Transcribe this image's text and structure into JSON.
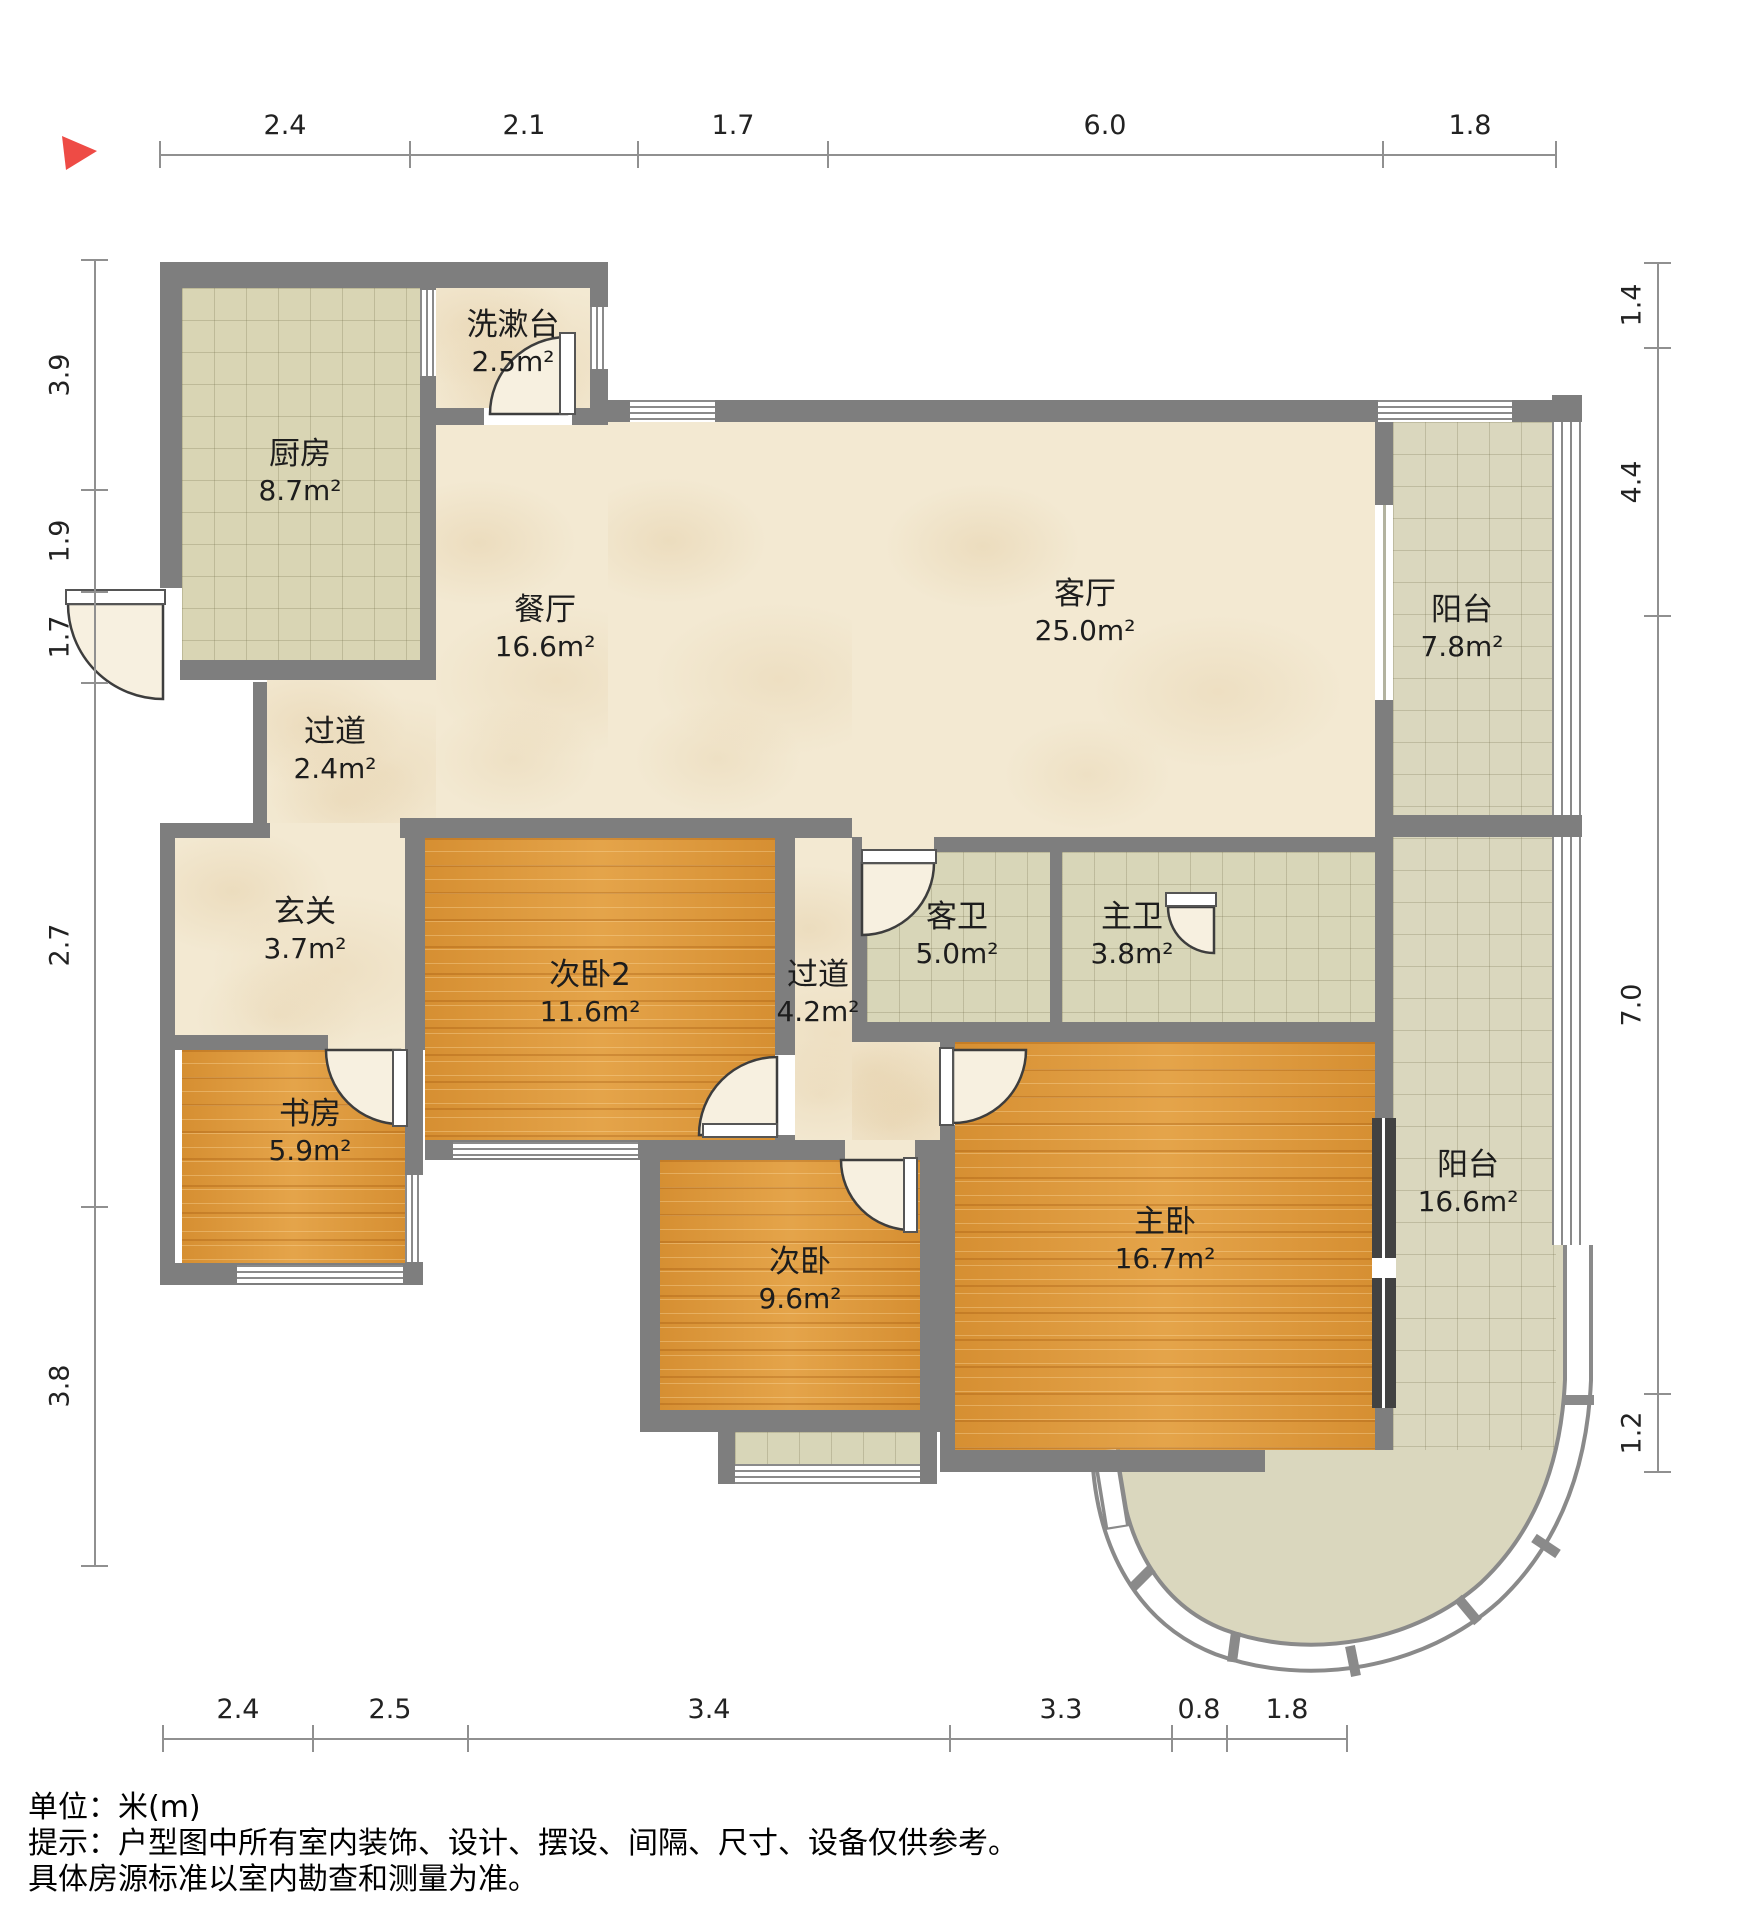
{
  "compass": {
    "direction_marker_color": "#ee4b45"
  },
  "dim_top": {
    "labels": [
      "2.4",
      "2.1",
      "1.7",
      "6.0",
      "1.8"
    ]
  },
  "dim_bottom": {
    "labels": [
      "2.4",
      "2.5",
      "3.4",
      "3.3",
      "0.8",
      "1.8"
    ]
  },
  "dim_left": {
    "labels": [
      "3.9",
      "1.9",
      "1.7",
      "2.7",
      "3.8"
    ]
  },
  "dim_right": {
    "labels": [
      "1.4",
      "4.4",
      "7.0",
      "1.2"
    ]
  },
  "rooms": [
    {
      "name": "厨房",
      "area": "8.7m²"
    },
    {
      "name": "洗漱台",
      "area": "2.5m²"
    },
    {
      "name": "餐厅",
      "area": "16.6m²"
    },
    {
      "name": "客厅",
      "area": "25.0m²"
    },
    {
      "name": "阳台",
      "area": "7.8m²"
    },
    {
      "name": "过道",
      "area": "2.4m²"
    },
    {
      "name": "玄关",
      "area": "3.7m²"
    },
    {
      "name": "次卧2",
      "area": "11.6m²"
    },
    {
      "name": "过道",
      "area": "4.2m²"
    },
    {
      "name": "客卫",
      "area": "5.0m²"
    },
    {
      "name": "主卫",
      "area": "3.8m²"
    },
    {
      "name": "书房",
      "area": "5.9m²"
    },
    {
      "name": "次卧",
      "area": "9.6m²"
    },
    {
      "name": "主卧",
      "area": "16.7m²"
    },
    {
      "name": "阳台",
      "area": "16.6m²"
    }
  ],
  "colors": {
    "wall": "#7e7e7e",
    "wood_floor": "#de9a3c",
    "marble_floor": "#f3e9d2",
    "tile_floor": "#d8d6b8",
    "balcony_floor": "#dad7be"
  },
  "footer": {
    "line1": "单位：米(m)",
    "line2": "提示：户型图中所有室内装饰、设计、摆设、间隔、尺寸、设备仅供参考。",
    "line3": "具体房源标准以室内勘查和测量为准。"
  }
}
